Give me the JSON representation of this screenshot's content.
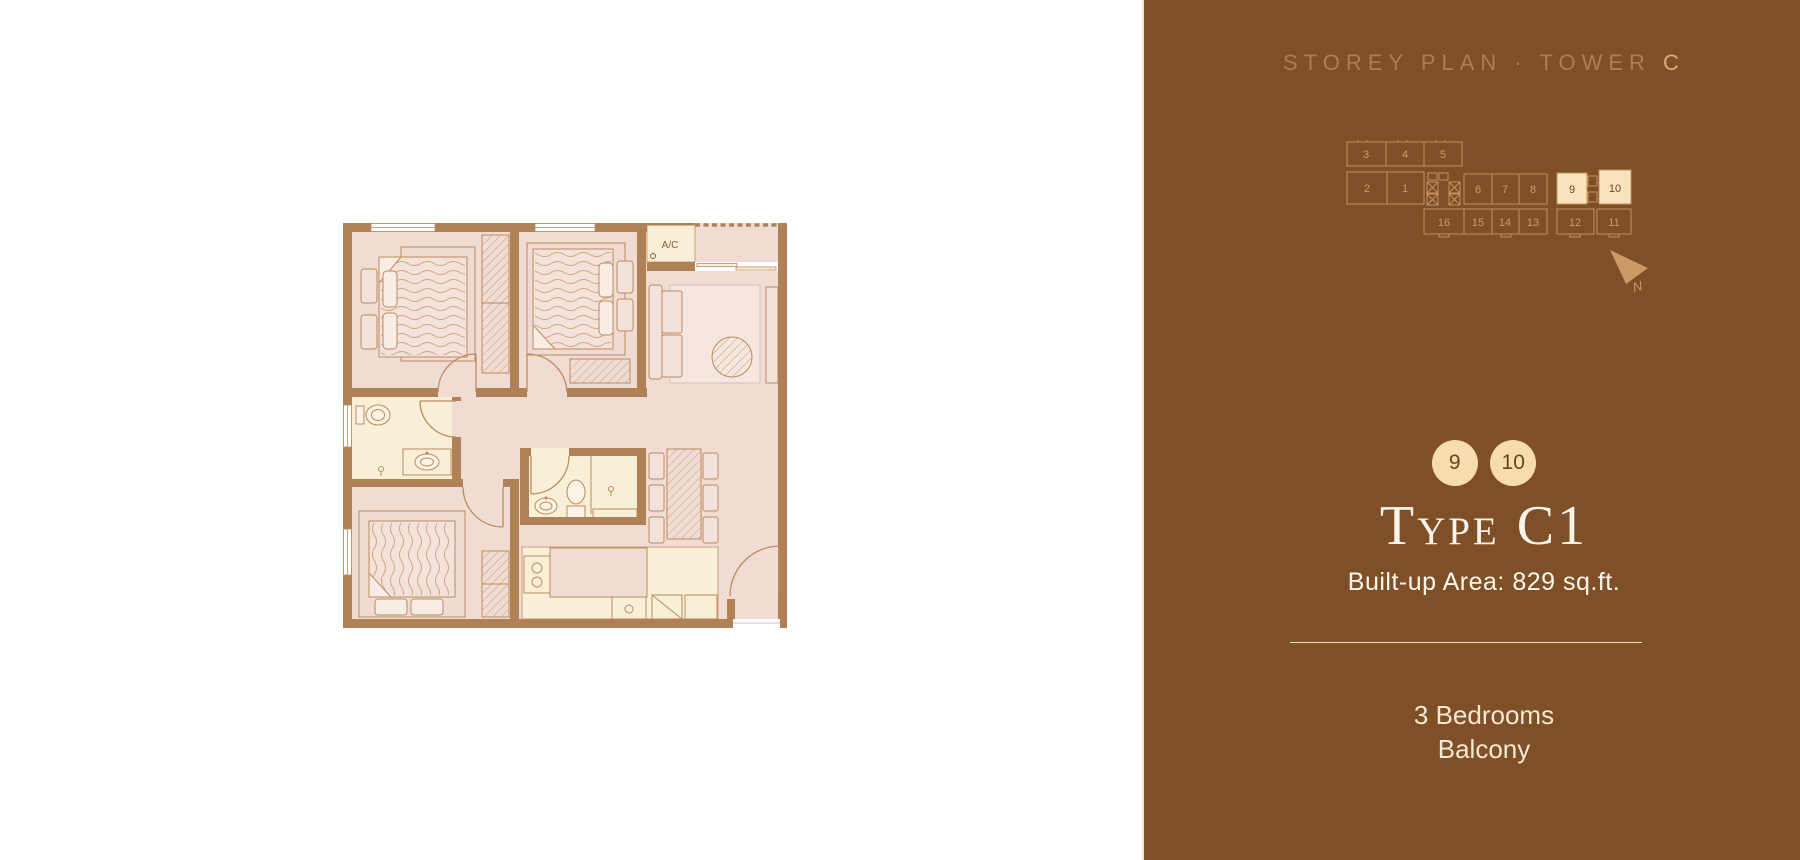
{
  "panel": {
    "heading": {
      "text": "STOREY PLAN · TOWER ",
      "highlight": "C"
    },
    "storey_map": {
      "units": [
        "1",
        "2",
        "3",
        "4",
        "5",
        "6",
        "7",
        "8",
        "9",
        "10",
        "11",
        "12",
        "13",
        "14",
        "15",
        "16"
      ],
      "highlighted_units": [
        "9",
        "10"
      ]
    },
    "north_label": "N",
    "badges": [
      "9",
      "10"
    ],
    "unit_type": "Type C1",
    "area": "Built-up Area: 829 sq.ft.",
    "features": [
      "3 Bedrooms",
      "Balcony"
    ]
  },
  "floor_plan": {
    "ac_label": "A/C"
  },
  "colors": {
    "panel_bg": "#7f4f27",
    "panel_edge": "#efe3d0",
    "heading": "#ab7e56",
    "heading_highlight": "#d8ac7e",
    "unit_outline": "#c6935f",
    "unit_number": "#cf9c66",
    "unit_highlight_fill": "#f8e3bd",
    "unit_highlight_text": "#6b4226",
    "badge_fill": "#f7ddae",
    "badge_text": "#6b4226",
    "title_text": "#f9f5ea",
    "body_text": "#f6e8d2",
    "divider": "#ecdfc8",
    "north_arrow": "#cc9865",
    "plan_wall": "#b08156",
    "plan_floor": "#f1dcd4",
    "plan_cream": "#f9efd7"
  }
}
